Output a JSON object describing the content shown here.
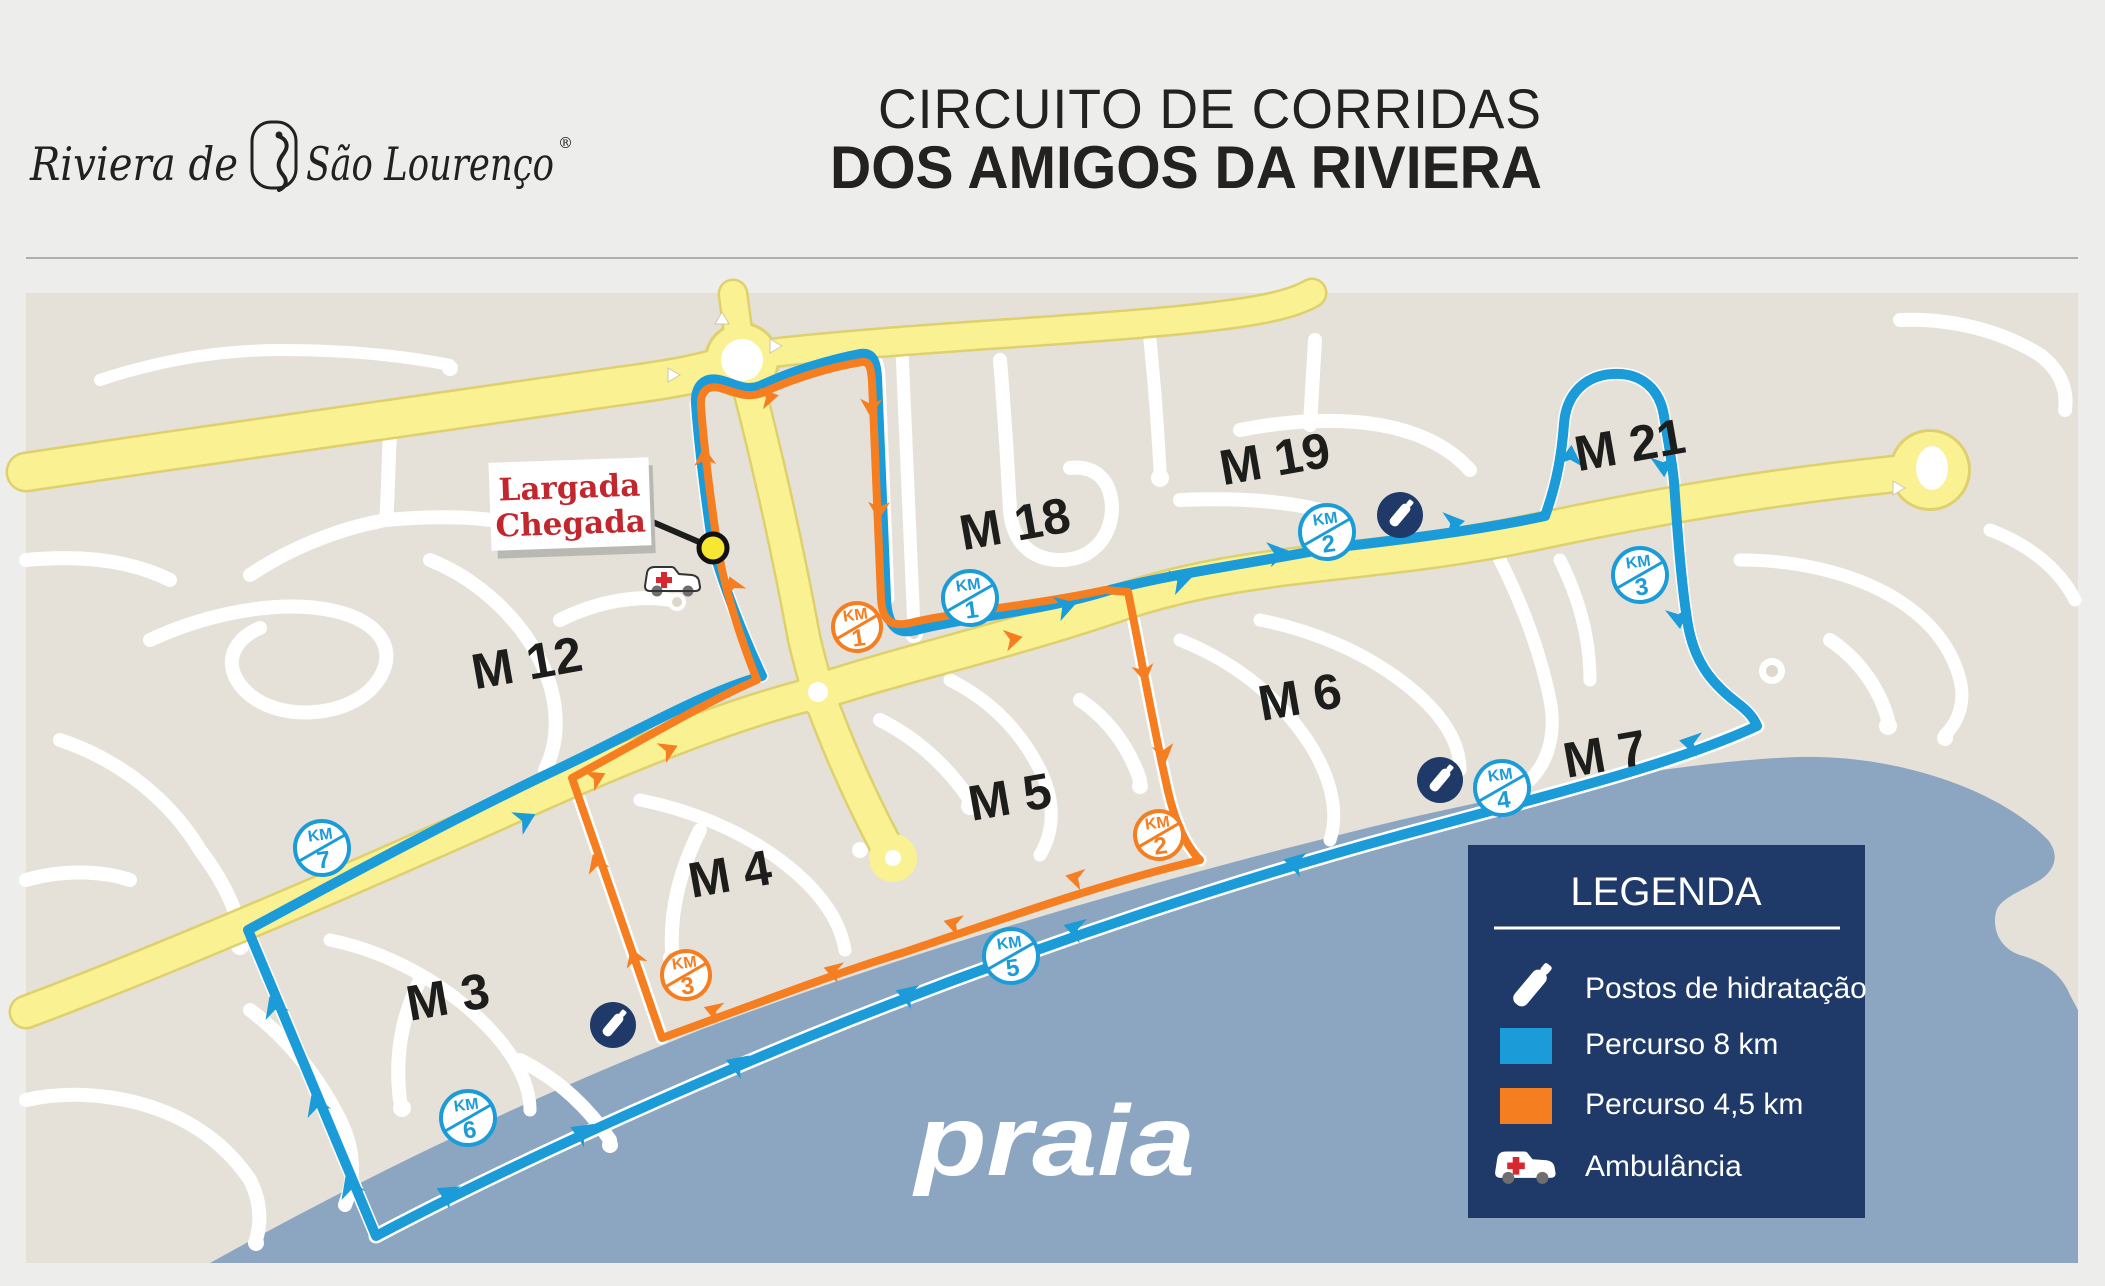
{
  "header": {
    "logo_prefix": "Riviera de",
    "logo_suffix": "São Lourenço",
    "logo_registered": "®",
    "title_line1": "CIRCUITO DE CORRIDAS",
    "title_line2": "DOS AMIGOS DA RIVIERA"
  },
  "map": {
    "start_sign": {
      "line1": "Largada",
      "line2": "Chegada"
    },
    "beach_label": "praia",
    "areas": [
      {
        "label": "M 12"
      },
      {
        "label": "M 18"
      },
      {
        "label": "M 19"
      },
      {
        "label": "M 21"
      },
      {
        "label": "M 7"
      },
      {
        "label": "M 6"
      },
      {
        "label": "M 5"
      },
      {
        "label": "M 4"
      },
      {
        "label": "M 3"
      }
    ],
    "km_markers": [
      {
        "route": "Percurso 8 km",
        "unit": "KM",
        "n": "1"
      },
      {
        "route": "Percurso 8 km",
        "unit": "KM",
        "n": "2"
      },
      {
        "route": "Percurso 8 km",
        "unit": "KM",
        "n": "3"
      },
      {
        "route": "Percurso 8 km",
        "unit": "KM",
        "n": "4"
      },
      {
        "route": "Percurso 8 km",
        "unit": "KM",
        "n": "5"
      },
      {
        "route": "Percurso 8 km",
        "unit": "KM",
        "n": "6"
      },
      {
        "route": "Percurso 8 km",
        "unit": "KM",
        "n": "7"
      },
      {
        "route": "Percurso 4,5 km",
        "unit": "KM",
        "n": "1"
      },
      {
        "route": "Percurso 4,5 km",
        "unit": "KM",
        "n": "2"
      },
      {
        "route": "Percurso 4,5 km",
        "unit": "KM",
        "n": "3"
      }
    ]
  },
  "legend": {
    "title": "LEGENDA",
    "items": [
      {
        "icon": "water-bottle-icon",
        "label": "Postos de hidratação"
      },
      {
        "icon": "route-8km-swatch",
        "label": "Percurso 8 km"
      },
      {
        "icon": "route-4-5km-swatch",
        "label": "Percurso 4,5 km"
      },
      {
        "icon": "ambulance-icon",
        "label": "Ambulância"
      }
    ]
  },
  "colors": {
    "route_8km": "#1B9CD8",
    "route_45km": "#F47E20",
    "ocean": "#8CA6C2",
    "legend_bg": "#1F3A68",
    "land": "#E6E1D8",
    "main_roads": "#F9F192",
    "sign_text": "#C1272D"
  }
}
